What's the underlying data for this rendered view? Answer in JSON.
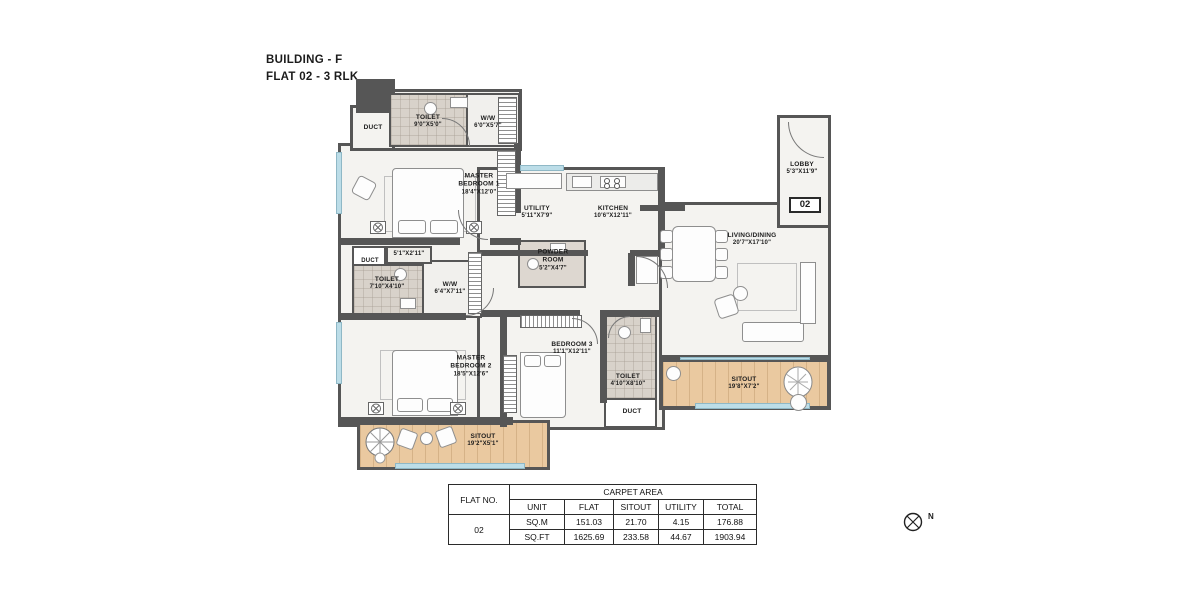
{
  "title": {
    "line1": "BUILDING - F",
    "line2": "FLAT 02 - 3 RLK"
  },
  "flat_badge": "02",
  "compass_label": "N",
  "ducts": [
    "DUCT",
    "DUCT",
    "DUCT"
  ],
  "rooms": {
    "toilet1": {
      "name": "TOILET",
      "dims": "9'0\"X5'0\""
    },
    "ww1": {
      "name": "W/W",
      "dims": "6'0\"X5'7\""
    },
    "master1": {
      "name": "MASTER BEDROOM 1",
      "dims": "18'4\"X12'0\""
    },
    "utility": {
      "name": "UTILITY",
      "dims": "5'11\"X7'9\""
    },
    "kitchen": {
      "name": "KITCHEN",
      "dims": "10'6\"X12'11\""
    },
    "lobby": {
      "name": "LOBBY",
      "dims": "5'3\"X11'9\""
    },
    "living": {
      "name": "LIVING/DINING",
      "dims": "20'7\"X17'10\""
    },
    "powder": {
      "name": "POWDER ROOM",
      "dims": "5'2\"X4'7\""
    },
    "passage": {
      "name": "",
      "dims": "5'1\"X2'11\""
    },
    "toilet2": {
      "name": "TOILET",
      "dims": "7'10\"X4'10\""
    },
    "ww2": {
      "name": "W/W",
      "dims": "6'4\"X7'11\""
    },
    "master2": {
      "name": "MASTER BEDROOM 2",
      "dims": "18'5\"X12'6\""
    },
    "bedroom3": {
      "name": "BEDROOM 3",
      "dims": "11'1\"X12'11\""
    },
    "toilet3": {
      "name": "TOILET",
      "dims": "4'10\"X8'10\""
    },
    "sitout_right": {
      "name": "SITOUT",
      "dims": "19'8\"X7'2\""
    },
    "sitout_left": {
      "name": "SITOUT",
      "dims": "19'2\"X5'1\""
    }
  },
  "area_table": {
    "flat_no_header": "FLAT NO.",
    "carpet_area_header": "CARPET AREA",
    "columns": [
      "UNIT",
      "FLAT",
      "SITOUT",
      "UTILITY",
      "TOTAL"
    ],
    "flat_no": "02",
    "rows": [
      {
        "unit": "SQ.M",
        "flat": "151.03",
        "sitout": "21.70",
        "utility": "4.15",
        "total": "176.88"
      },
      {
        "unit": "SQ.FT",
        "flat": "1625.69",
        "sitout": "233.58",
        "utility": "44.67",
        "total": "1903.94"
      }
    ]
  },
  "colors": {
    "wall": "#565656",
    "floor": "#f4f3f0",
    "tile": "#d8d2ca",
    "wood": "#eac9a0",
    "window": "#bcdde8"
  }
}
